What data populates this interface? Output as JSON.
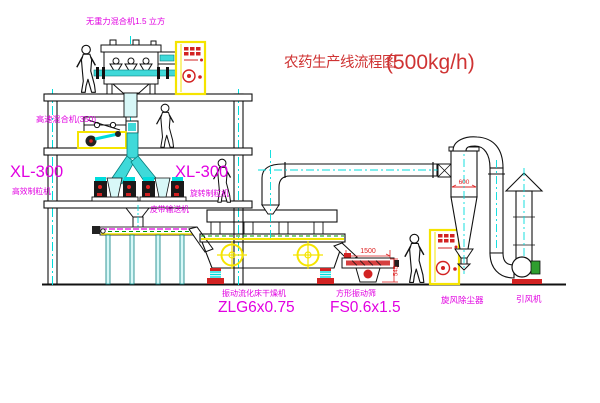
{
  "diagram": {
    "title": {
      "text": "农药生产线流程图",
      "capacity": "(500kg/h)"
    },
    "equipment": {
      "gravity_mixer_label": "无重力混合机1.5 立方",
      "high_speed_mixer_label": "高速混合机(350)",
      "granulator_left": {
        "model": "XL-300",
        "name": "高效制粒机"
      },
      "granulator_right": {
        "model": "XL-300",
        "name": "旋转制粒机"
      },
      "belt_conveyor_label": "皮带输送机",
      "dryer": {
        "name": "振动流化床干燥机",
        "model": "ZLG6x0.75"
      },
      "screen": {
        "name": "方形振动筛",
        "model": "FS0.6x1.5"
      },
      "cyclone_label": "旋风除尘器",
      "fan_label": "引风机"
    },
    "dimensions": {
      "screen_length": "1500",
      "screen_height": "545",
      "cyclone_outlet": "600"
    },
    "colors": {
      "label_magenta": "#e100e1",
      "title_red": "#cf3333",
      "dimension_red": "#dd2222",
      "cad_yellow": "#f5e400",
      "cad_cyan": "#00dcdc",
      "belt_green": "#009900"
    }
  }
}
